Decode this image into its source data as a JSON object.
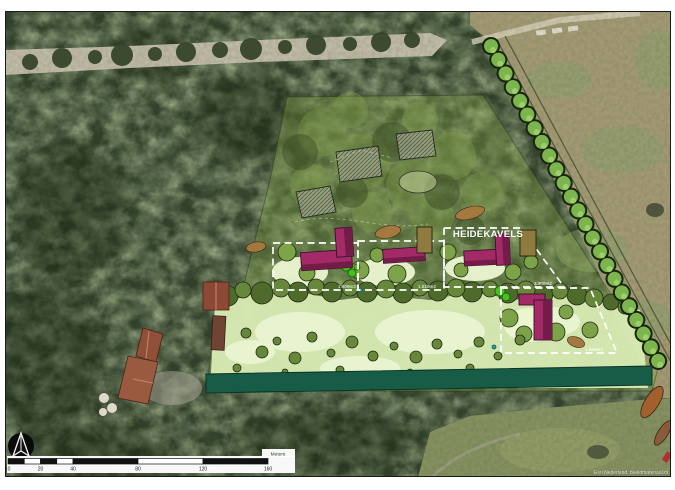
{
  "map": {
    "area_title": "HEIDEKAVELS",
    "plots": [
      {
        "name": "plot-1",
        "area_label": "1.609m2"
      },
      {
        "name": "plot-2",
        "area_label": "1.819m2"
      },
      {
        "name": "plot-3",
        "area_label": "2.306m2"
      },
      {
        "name": "plot-4",
        "area_label": "1.986m2"
      }
    ],
    "scale_bar": {
      "tick_labels": [
        "0",
        "20",
        "40",
        "80",
        "120",
        "160"
      ],
      "unit_label": "Meters"
    },
    "attribution": "Esri Nederland, beeldmateriaal.nl"
  },
  "colors": {
    "forest_base": "#31402a",
    "field_tan": "#a39a74",
    "field_green": "#85915f",
    "road": "#c6c0ac",
    "plan_wash": "#8cae4b",
    "meadow": "#d9ebb4",
    "clearing": "#ecf7d2",
    "canopy_dark": "#4f6b2c",
    "canopy_mid": "#67873a",
    "canopy_light": "#7da348",
    "tree_row_green": "#7cb44e",
    "building": "#a32a67",
    "building_shade": "#731c49",
    "shed_brown": "#8f7b3f",
    "soil_brown": "#a4783f",
    "hedge_teal": "#1c6b52",
    "boundary_dash": "#ffffff",
    "roof_brown": "#9a5a40"
  }
}
